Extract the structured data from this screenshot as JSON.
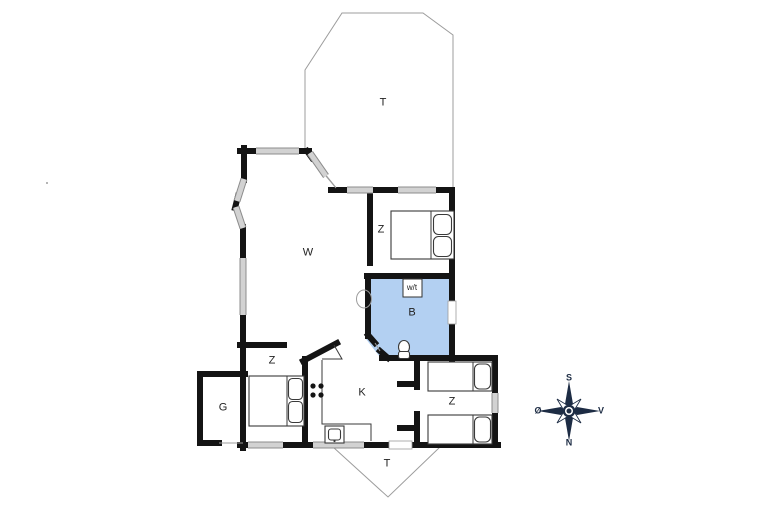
{
  "type": "floor-plan",
  "rooms": {
    "terrace_top": {
      "label": "T"
    },
    "living_room": {
      "label": "W"
    },
    "bedroom_top_right": {
      "label": "Z"
    },
    "bathroom": {
      "label": "B"
    },
    "washer_dryer": {
      "label": "w/t"
    },
    "kitchen": {
      "label": "K"
    },
    "bedroom_bottom_left": {
      "label": "Z"
    },
    "garage": {
      "label": "G"
    },
    "bedroom_bottom_right": {
      "label": "Z"
    },
    "terrace_bottom": {
      "label": "T"
    }
  },
  "compass": {
    "south": "S",
    "north": "N",
    "east": "Ø",
    "west": "V"
  },
  "colors": {
    "wall": "#141414",
    "window_fill": "#d2d2d2",
    "window_edge": "#8c8c8c",
    "bathroom_fill": "#b3d0f2",
    "outline_thin": "#9c9c9c",
    "furniture_line": "#3a3a3a",
    "compass_color": "#1d2c44",
    "label_color": "#222222",
    "background": "#ffffff"
  }
}
